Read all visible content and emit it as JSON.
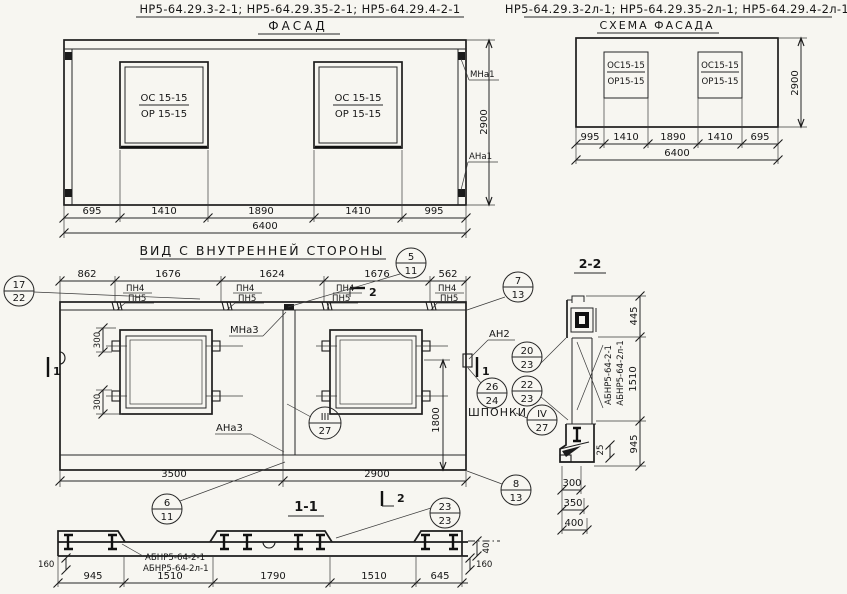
{
  "sheet": {
    "facade": {
      "codes": "НР5-64.29.3-2-1; НР5-64.29.35-2-1; НР5-64.29.4-2-1",
      "title": "ФАСАД",
      "win_top": "ОС 15-15",
      "win_bot": "ОР 15-15",
      "mark_top": "МНа1",
      "mark_bot": "АНа1",
      "height": "2900",
      "total": "6400",
      "dims": [
        "695",
        "1410",
        "1890",
        "1410",
        "995"
      ]
    },
    "schema": {
      "codes": "НР5-64.29.3-2л-1; НР5-64.29.35-2л-1; НР5-64.29.4-2л-1",
      "title": "СХЕМА ФАСАДА",
      "win_top": "ОС15-15",
      "win_bot": "ОР15-15",
      "height": "2900",
      "total": "6400",
      "dims": [
        "995",
        "1410",
        "1890",
        "1410",
        "695"
      ]
    },
    "inner": {
      "title": "ВИД С ВНУТРЕННЕЙ СТОРОНЫ",
      "dims_top": [
        "862",
        "1676",
        "1624",
        "1676",
        "562"
      ],
      "pn4": "ПН4",
      "pn5": "ПН5",
      "d300": "300",
      "d1800": "1800",
      "mna3": "МНа3",
      "ana3": "АНа3",
      "an2": "АН2",
      "shponki": "ШПОНКИ",
      "d3500": "3500",
      "d2900": "2900",
      "sec1": "1",
      "sec2": "2"
    },
    "sec11": {
      "title": "1-1",
      "label1": "АБНР5-64-2-1",
      "label2": "АБНР5-64-2л-1",
      "dims": [
        "945",
        "1510",
        "1790",
        "1510",
        "645"
      ],
      "d160": "160",
      "d40": "40"
    },
    "sec22": {
      "title": "2-2",
      "label1": "АБНР5-64-2-1",
      "label2": "АБНР5-64-2л-1",
      "d445": "445",
      "d1510": "1510",
      "d945": "945",
      "d25": "25",
      "d300": "300",
      "d350": "350",
      "d400": "400"
    },
    "callouts": {
      "c17": {
        "t": "17",
        "b": "22"
      },
      "c5": {
        "t": "5",
        "b": "11"
      },
      "c7": {
        "t": "7",
        "b": "13"
      },
      "c20": {
        "t": "20",
        "b": "23"
      },
      "c26": {
        "t": "26",
        "b": "24"
      },
      "c22": {
        "t": "22",
        "b": "23"
      },
      "c3": {
        "t": "III",
        "b": "27"
      },
      "c4": {
        "t": "IV",
        "b": "27"
      },
      "c6": {
        "t": "6",
        "b": "11"
      },
      "c23": {
        "t": "23",
        "b": "23"
      },
      "c8": {
        "t": "8",
        "b": "13"
      }
    }
  }
}
